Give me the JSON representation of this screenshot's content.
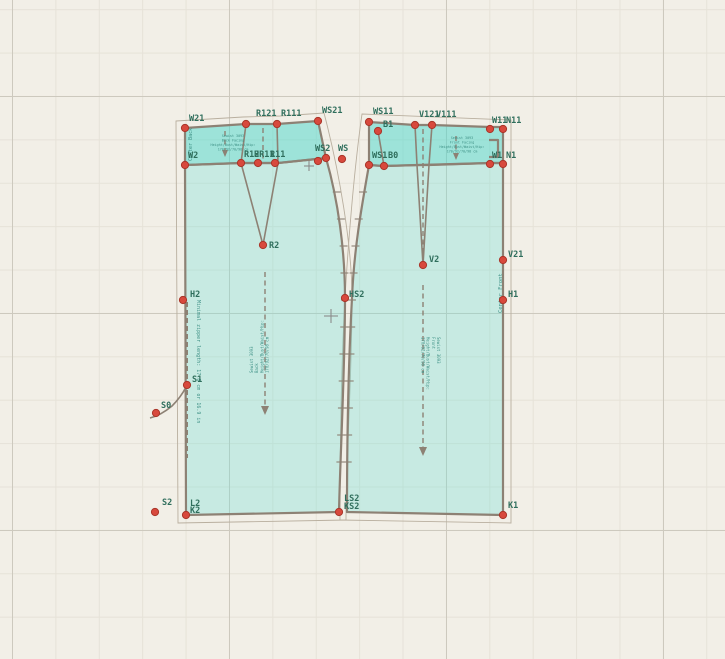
{
  "canvas": {
    "width": 725,
    "height": 659
  },
  "colors": {
    "background": "#f2efe7",
    "grid_minor": "#e6e2d8",
    "grid_major": "#cdc9be",
    "piece_fill": "rgba(110,224,214,0.32)",
    "facing_fill": "rgba(72,215,204,0.5)",
    "outline": "#8d8174",
    "seam_allowance": "#b9af9f",
    "point_fill": "#d8493d",
    "point_stroke": "#a93529",
    "label_color": "#2f6e5c",
    "info_text": "#3f9186"
  },
  "texts": {
    "back_facing_lines": [
      "Sewist 3093",
      "Back Facing",
      "Height/Bust/Waist/Hip:",
      "170/92/70/98 cm"
    ],
    "front_facing_lines": [
      "Sewist 3093",
      "Front Facing",
      "Height/Bust/Waist/Hip:",
      "170/92/70/98 cm"
    ],
    "back_info_lines": [
      "Sewist 3093",
      "Back",
      "Height/Bust/Waist/Hip:",
      "170/92/70/98 cm"
    ],
    "front_info_lines": [
      "Sewist 3093",
      "Front",
      "Height/Bust/Waist/Hip:",
      "170/92/70/98 cm"
    ],
    "center_back": "Center Back",
    "center_front": "Center Front",
    "zipper_note": "Minimal zipper length: 17.8 cm or 16.9 in"
  },
  "points": [
    {
      "id": "W21",
      "x": 185,
      "y": 128,
      "label": "W21",
      "lx": 189,
      "ly": 121
    },
    {
      "id": "W2",
      "x": 185,
      "y": 165,
      "label": "W2",
      "lx": 188,
      "ly": 158
    },
    {
      "id": "R121",
      "x": 246,
      "y": 124,
      "label": "R121",
      "lx": 256,
      "ly": 116
    },
    {
      "id": "R111",
      "x": 277,
      "y": 124,
      "label": "R111",
      "lx": 281,
      "ly": 116
    },
    {
      "id": "WS21",
      "x": 318,
      "y": 121,
      "label": "WS21",
      "lx": 322,
      "ly": 113
    },
    {
      "id": "R12",
      "x": 241,
      "y": 163,
      "label": "R12",
      "lx": 244,
      "ly": 157
    },
    {
      "id": "R11",
      "x": 258,
      "y": 163,
      "label": "R11",
      "lx": 270,
      "ly": 157
    },
    {
      "id": "HR11",
      "x": 275,
      "y": 163,
      "label": "HR11",
      "lx": 254,
      "ly": 157
    },
    {
      "id": "HW2",
      "x": 318,
      "y": 161,
      "label": ""
    },
    {
      "id": "WS2",
      "x": 326,
      "y": 158,
      "label": "WS2",
      "lx": 315,
      "ly": 151
    },
    {
      "id": "WS",
      "x": 342,
      "y": 159,
      "label": "WS",
      "lx": 338,
      "ly": 151
    },
    {
      "id": "R2",
      "x": 263,
      "y": 245,
      "label": "R2",
      "lx": 269,
      "ly": 248
    },
    {
      "id": "H2",
      "x": 183,
      "y": 300,
      "label": "H2",
      "lx": 190,
      "ly": 297
    },
    {
      "id": "S1",
      "x": 187,
      "y": 385,
      "label": "S1",
      "lx": 192,
      "ly": 382
    },
    {
      "id": "S0",
      "x": 156,
      "y": 413,
      "label": "S0",
      "lx": 161,
      "ly": 408
    },
    {
      "id": "S2",
      "x": 155,
      "y": 512,
      "label": "S2",
      "lx": 162,
      "ly": 505
    },
    {
      "id": "L2",
      "x": 186,
      "y": 515,
      "label": "L2",
      "lx": 190,
      "ly": 506
    },
    {
      "id": "K2",
      "x": 186,
      "y": 515,
      "label": "K2",
      "lx": 190,
      "ly": 513,
      "dot": false
    },
    {
      "id": "LS2",
      "x": 339,
      "y": 512,
      "label": "LS2",
      "lx": 344,
      "ly": 501
    },
    {
      "id": "KS2",
      "x": 339,
      "y": 512,
      "label": "KS2",
      "lx": 344,
      "ly": 509,
      "dot": false
    },
    {
      "id": "HS2",
      "x": 345,
      "y": 298,
      "label": "HS2",
      "lx": 349,
      "ly": 297
    },
    {
      "id": "WS11",
      "x": 369,
      "y": 122,
      "label": "WS11",
      "lx": 373,
      "ly": 114
    },
    {
      "id": "B1",
      "x": 378,
      "y": 131,
      "label": "B1",
      "lx": 383,
      "ly": 127
    },
    {
      "id": "V121",
      "x": 415,
      "y": 125,
      "label": "V121",
      "lx": 419,
      "ly": 117
    },
    {
      "id": "V111",
      "x": 432,
      "y": 125,
      "label": "V111",
      "lx": 436,
      "ly": 117
    },
    {
      "id": "W11",
      "x": 490,
      "y": 129,
      "label": "W11",
      "lx": 492,
      "ly": 123
    },
    {
      "id": "N11",
      "x": 503,
      "y": 129,
      "label": "N11",
      "lx": 506,
      "ly": 123
    },
    {
      "id": "WS1",
      "x": 369,
      "y": 165,
      "label": "WS1",
      "lx": 372,
      "ly": 158
    },
    {
      "id": "B0",
      "x": 384,
      "y": 166,
      "label": "B0",
      "lx": 388,
      "ly": 158
    },
    {
      "id": "W1",
      "x": 490,
      "y": 164,
      "label": "W1",
      "lx": 492,
      "ly": 158
    },
    {
      "id": "N1",
      "x": 503,
      "y": 164,
      "label": "N1",
      "lx": 506,
      "ly": 158
    },
    {
      "id": "V2",
      "x": 423,
      "y": 265,
      "label": "V2",
      "lx": 429,
      "ly": 262
    },
    {
      "id": "V21",
      "x": 503,
      "y": 260,
      "label": "V21",
      "lx": 508,
      "ly": 257
    },
    {
      "id": "H1",
      "x": 503,
      "y": 300,
      "label": "H1",
      "lx": 508,
      "ly": 297
    },
    {
      "id": "K1",
      "x": 503,
      "y": 515,
      "label": "K1",
      "lx": 508,
      "ly": 508
    }
  ]
}
